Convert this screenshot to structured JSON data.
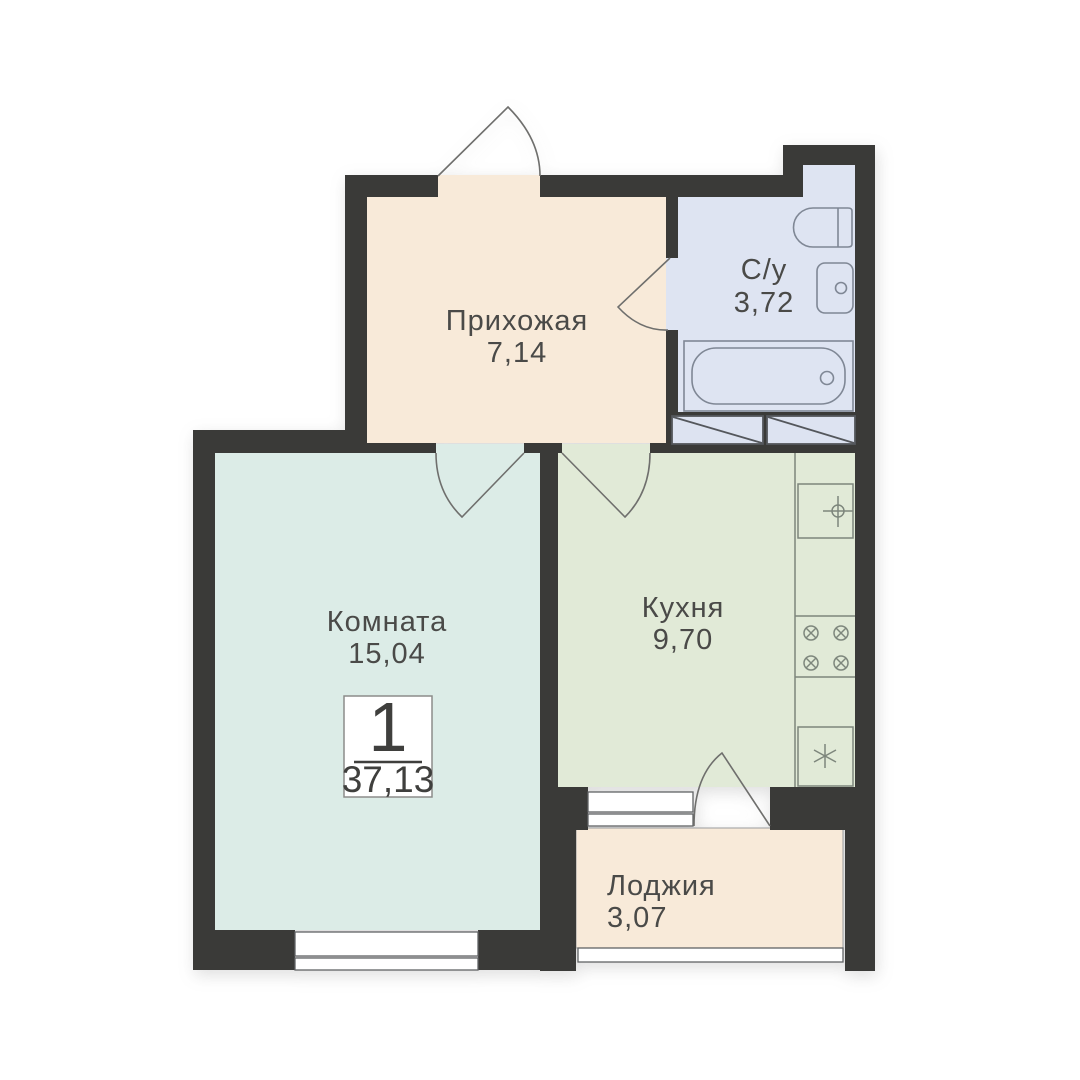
{
  "plan": {
    "title": "1-room apartment floor plan",
    "badge": {
      "rooms_count": "1",
      "total_area": "37,13"
    },
    "rooms": [
      {
        "id": "hallway",
        "name": "Прихожая",
        "area": "7,14"
      },
      {
        "id": "bathroom",
        "name": "С/у",
        "area": "3,72"
      },
      {
        "id": "room",
        "name": "Комната",
        "area": "15,04"
      },
      {
        "id": "kitchen",
        "name": "Кухня",
        "area": "9,70"
      },
      {
        "id": "loggia",
        "name": "Лоджия",
        "area": "3,07"
      }
    ],
    "colors": {
      "wall": "#3a3a38",
      "hallway_floor": "#f8ead9",
      "bathroom_floor": "#dee4f2",
      "room_floor": "#dcece7",
      "kitchen_floor": "#e1ead7",
      "loggia_floor": "#f8ead9",
      "bath_fixture_line": "#7f8795",
      "kitchen_fixture_line": "#7d867c",
      "door_line": "#6f6f6d",
      "window_line": "#616365",
      "label_text": "#4a4a48",
      "background": "#ffffff"
    }
  }
}
